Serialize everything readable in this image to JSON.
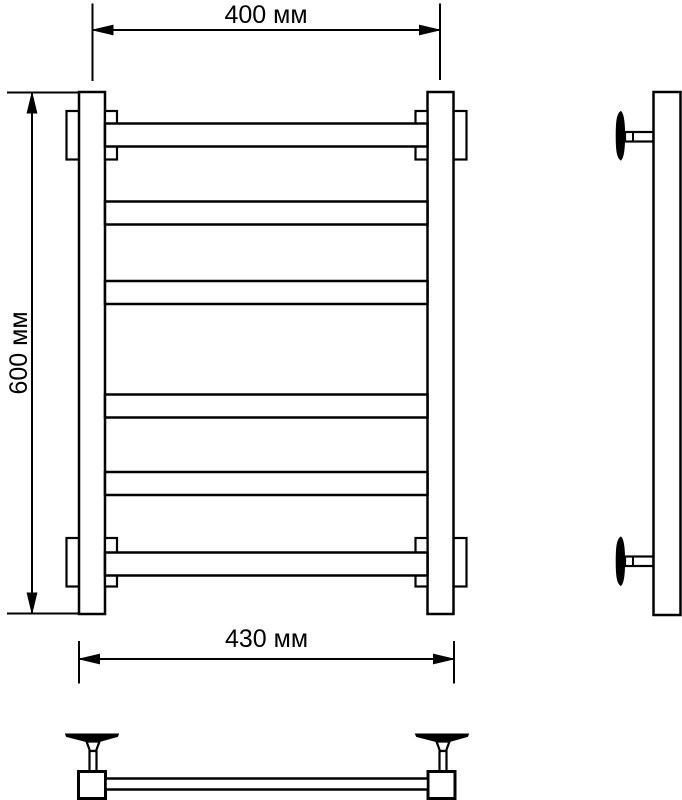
{
  "page": {
    "background_color": "#ffffff",
    "line_color": "#000000",
    "description": "Technical drawing of ladder towel rail: front, side and top views with dimensions"
  },
  "dimensions": {
    "top_width": "400 мм",
    "left_height": "600 мм",
    "bottom_width": "430 мм"
  },
  "views": {
    "front": {
      "rung_count": 6,
      "wall_bracket_count": 4
    },
    "side": {
      "wall_bracket_count": 2
    },
    "top": {
      "wall_bracket_count": 2
    }
  }
}
